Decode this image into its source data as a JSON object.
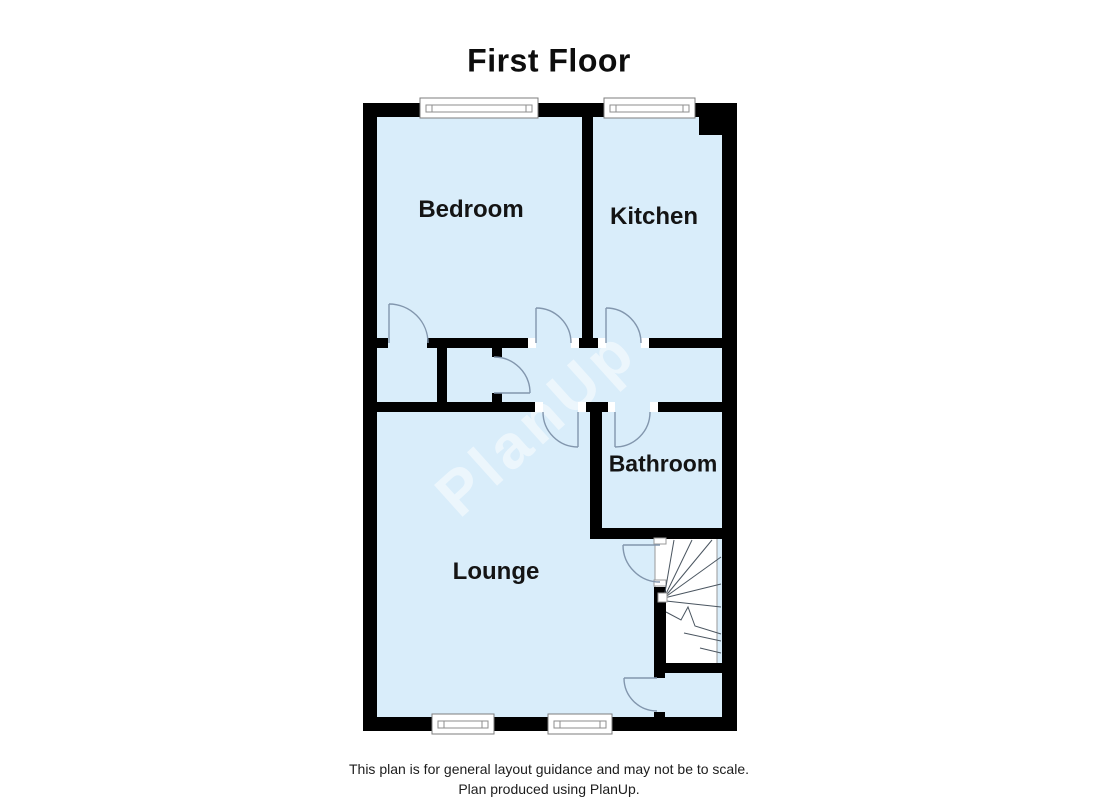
{
  "title": "First Floor",
  "rooms": {
    "bedroom": {
      "label": "Bedroom"
    },
    "kitchen": {
      "label": "Kitchen"
    },
    "bathroom": {
      "label": "Bathroom"
    },
    "lounge": {
      "label": "Lounge"
    }
  },
  "watermark": "PlanUp",
  "footer": {
    "line1": "This plan is for general layout guidance and may not be to scale.",
    "line2": "Plan produced using PlanUp."
  },
  "colors": {
    "room_fill": "#d9edfa",
    "wall": "#000000",
    "door_swing": "#8296ad",
    "stair_bg": "#ffffff",
    "stair_line": "#4a5560"
  }
}
